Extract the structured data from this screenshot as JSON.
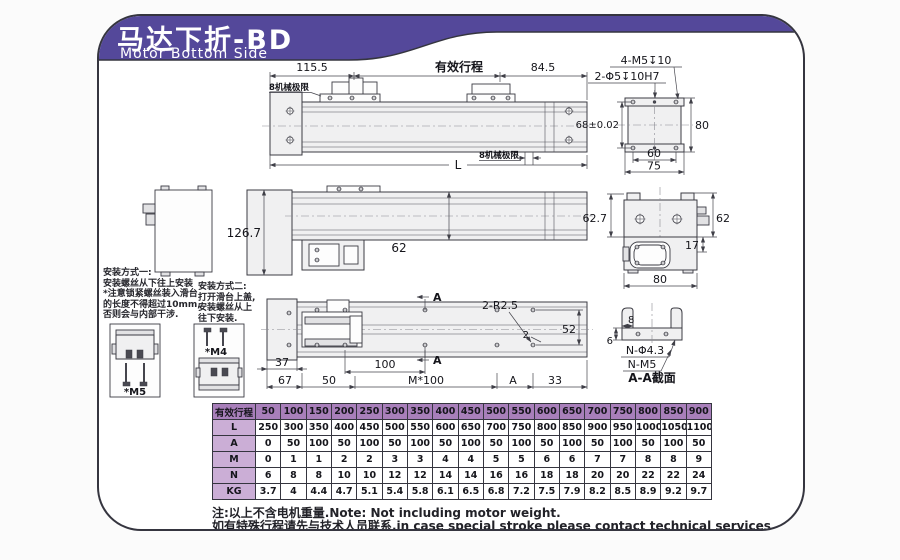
{
  "banner": {
    "title": "马达下折-BD",
    "subtitle": "Motor Bottom Side"
  },
  "colors": {
    "banner": "#54489a",
    "th": "#a87fba",
    "lbl": "#cbaed6",
    "border": "#35353f"
  },
  "top_view": {
    "dim_left": "115.5",
    "stroke_label": "有效行程",
    "dim_right": "84.5",
    "mech_limit_top": "8机械极限",
    "mech_limit_bottom": "8机械极限",
    "dim_length": "L"
  },
  "end_plate": {
    "thread_label": "4-M5↧10",
    "dowel_label": "2-Φ5↧10H7",
    "dim_width": "68±0.02",
    "dim_height": "80",
    "dim_hole_spacing": "60",
    "dim_total_width": "75"
  },
  "side_view": {
    "dim_height": "126.7",
    "dim_rail_height": "62"
  },
  "motor_end_view": {
    "dim_left": "62.7",
    "dim_right": "62",
    "dim_offset": "17",
    "dim_width": "80"
  },
  "bottom_view": {
    "corner_label": "2-R2.5",
    "dim_52": "52",
    "dim_2": "2",
    "section_label": "A",
    "dim_37": "37",
    "dim_67": "67",
    "dim_50": "50",
    "dim_100": "100",
    "dim_m100": "M*100",
    "dim_a": "A",
    "dim_33": "33"
  },
  "section_view": {
    "dim_8": "8",
    "dim_6": "6",
    "hole_label": "N-Φ4.3",
    "thread_label": "N-M5",
    "caption": "A-A截面"
  },
  "install": {
    "method1": {
      "title": "安装方式一:",
      "lines": [
        "安装螺丝从下往上安装",
        "*注意锁紧螺丝装入滑台",
        "的长度不得超过10mm,",
        "否则会与内部干涉."
      ],
      "label": "*M5"
    },
    "method2": {
      "title": "安装方式二:",
      "lines": [
        "打开滑台上盖,",
        "安装螺丝从上",
        "往下安装."
      ],
      "label": "*M4"
    }
  },
  "table": {
    "header_label": "有效行程",
    "strokes": [
      "50",
      "100",
      "150",
      "200",
      "250",
      "300",
      "350",
      "400",
      "450",
      "500",
      "550",
      "600",
      "650",
      "700",
      "750",
      "800",
      "850",
      "900"
    ],
    "rows": [
      {
        "label": "L",
        "values": [
          "250",
          "300",
          "350",
          "400",
          "450",
          "500",
          "550",
          "600",
          "650",
          "700",
          "750",
          "800",
          "850",
          "900",
          "950",
          "1000",
          "1050",
          "1100"
        ]
      },
      {
        "label": "A",
        "values": [
          "0",
          "50",
          "100",
          "50",
          "100",
          "50",
          "100",
          "50",
          "100",
          "50",
          "100",
          "50",
          "100",
          "50",
          "100",
          "50",
          "100",
          "50"
        ]
      },
      {
        "label": "M",
        "values": [
          "0",
          "1",
          "1",
          "2",
          "2",
          "3",
          "3",
          "4",
          "4",
          "5",
          "5",
          "6",
          "6",
          "7",
          "7",
          "8",
          "8",
          "9"
        ]
      },
      {
        "label": "N",
        "values": [
          "6",
          "8",
          "8",
          "10",
          "10",
          "12",
          "12",
          "14",
          "14",
          "16",
          "16",
          "18",
          "18",
          "20",
          "20",
          "22",
          "22",
          "24"
        ]
      },
      {
        "label": "KG",
        "values": [
          "3.7",
          "4",
          "4.4",
          "4.7",
          "5.1",
          "5.4",
          "5.8",
          "6.1",
          "6.5",
          "6.8",
          "7.2",
          "7.5",
          "7.9",
          "8.2",
          "8.5",
          "8.9",
          "9.2",
          "9.7"
        ]
      }
    ]
  },
  "notes": {
    "line1": "注:以上不含电机重量.Note: Not including motor weight.",
    "line2": "如有特殊行程请先与技术人员联系.in case special stroke please contact technical services."
  }
}
